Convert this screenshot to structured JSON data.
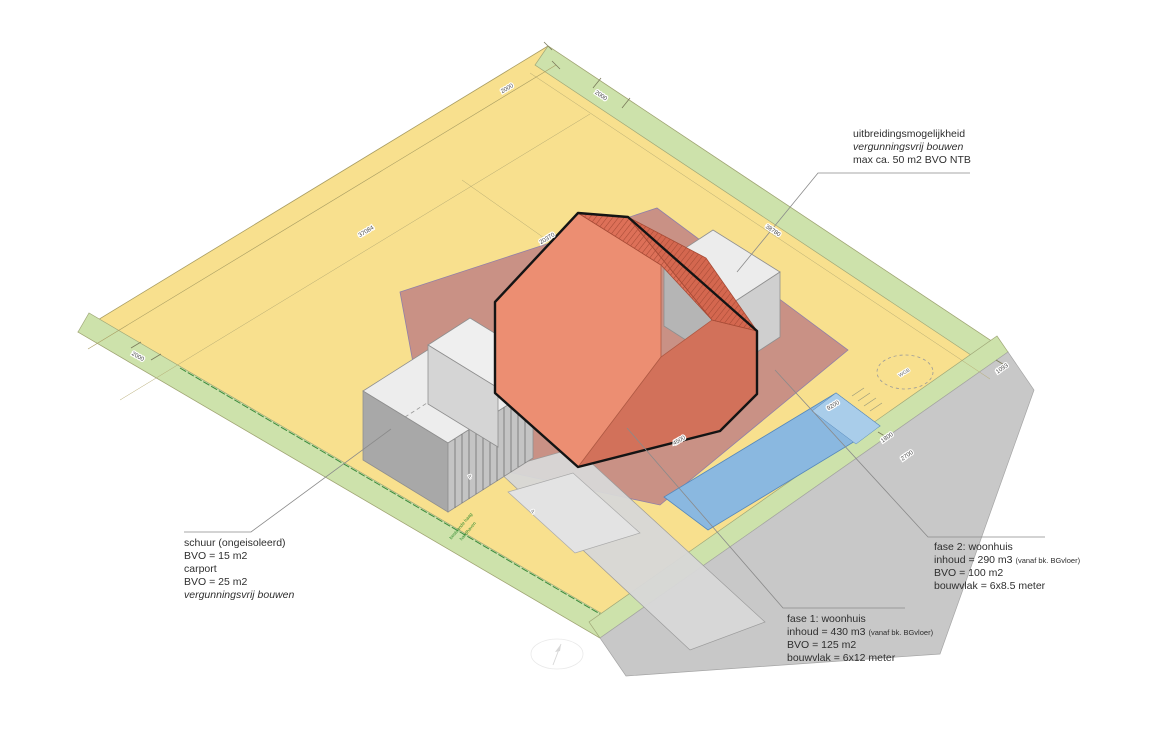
{
  "annotations": {
    "uitbreiding": {
      "line1": "uitbreidingsmogelijkheid",
      "line2": "vergunningsvrij bouwen",
      "line3": "max ca. 50 m2 BVO NTB"
    },
    "schuur": {
      "line1": "schuur (ongeisoleerd)",
      "line2": "BVO = 15 m2",
      "line3": "carport",
      "line4": "BVO = 25 m2",
      "line5": "vergunningsvrij bouwen"
    },
    "fase1": {
      "title": "fase 1: woonhuis",
      "inhoud": "inhoud = 430 m3",
      "inhoud_note": "(vanaf bk. BGvloer)",
      "bvo": "BVO = 125 m2",
      "bouwvlak": "bouwvlak = 6x12 meter"
    },
    "fase2": {
      "title": "fase 2: woonhuis",
      "inhoud": "inhoud = 290 m3",
      "inhoud_note": "(vanaf bk. BGvloer)",
      "bvo": "BVO = 100 m2",
      "bouwvlak": "bouwvlak = 6x8.5 meter"
    },
    "hedge_note_1": "bestaande haag",
    "hedge_note_2": "handhaven"
  },
  "dimensions": {
    "top_left_offset": "2000",
    "top_right_offset": "2000",
    "edge_left": "37084",
    "center": "20370",
    "edge_right": "38780",
    "left_corner_offset": "2000",
    "right_corner_offset": "1093",
    "pool": "9200",
    "green_strip": "1800",
    "road": "2700",
    "house_side": "4500"
  },
  "markers": {
    "tree_label": "WGB",
    "parking_1": "P",
    "parking_2": "P"
  },
  "colors": {
    "plot_yellow": "#f8e08e",
    "strip_green": "#cde2ab",
    "road_gray": "#c8c8c8",
    "erf_mauve": "#c68b85",
    "roof_terracotta": "#dd7058",
    "roof_terracotta_dark": "#d4674f",
    "facade_light": "#ec8e72",
    "facade_dark": "#d2715a",
    "pool_blue": "#8ab8e0",
    "pool_blue_light": "#a9cdea",
    "white_volume": "#ececec",
    "white_volume_side": "#cfcfcf",
    "white_volume_dark": "#b5b5b5",
    "shed_wall": "#a8a8a8",
    "driveway_gray": "#d8d8d8",
    "outline_black": "#141414",
    "hedge_green": "#3a8a3a"
  }
}
